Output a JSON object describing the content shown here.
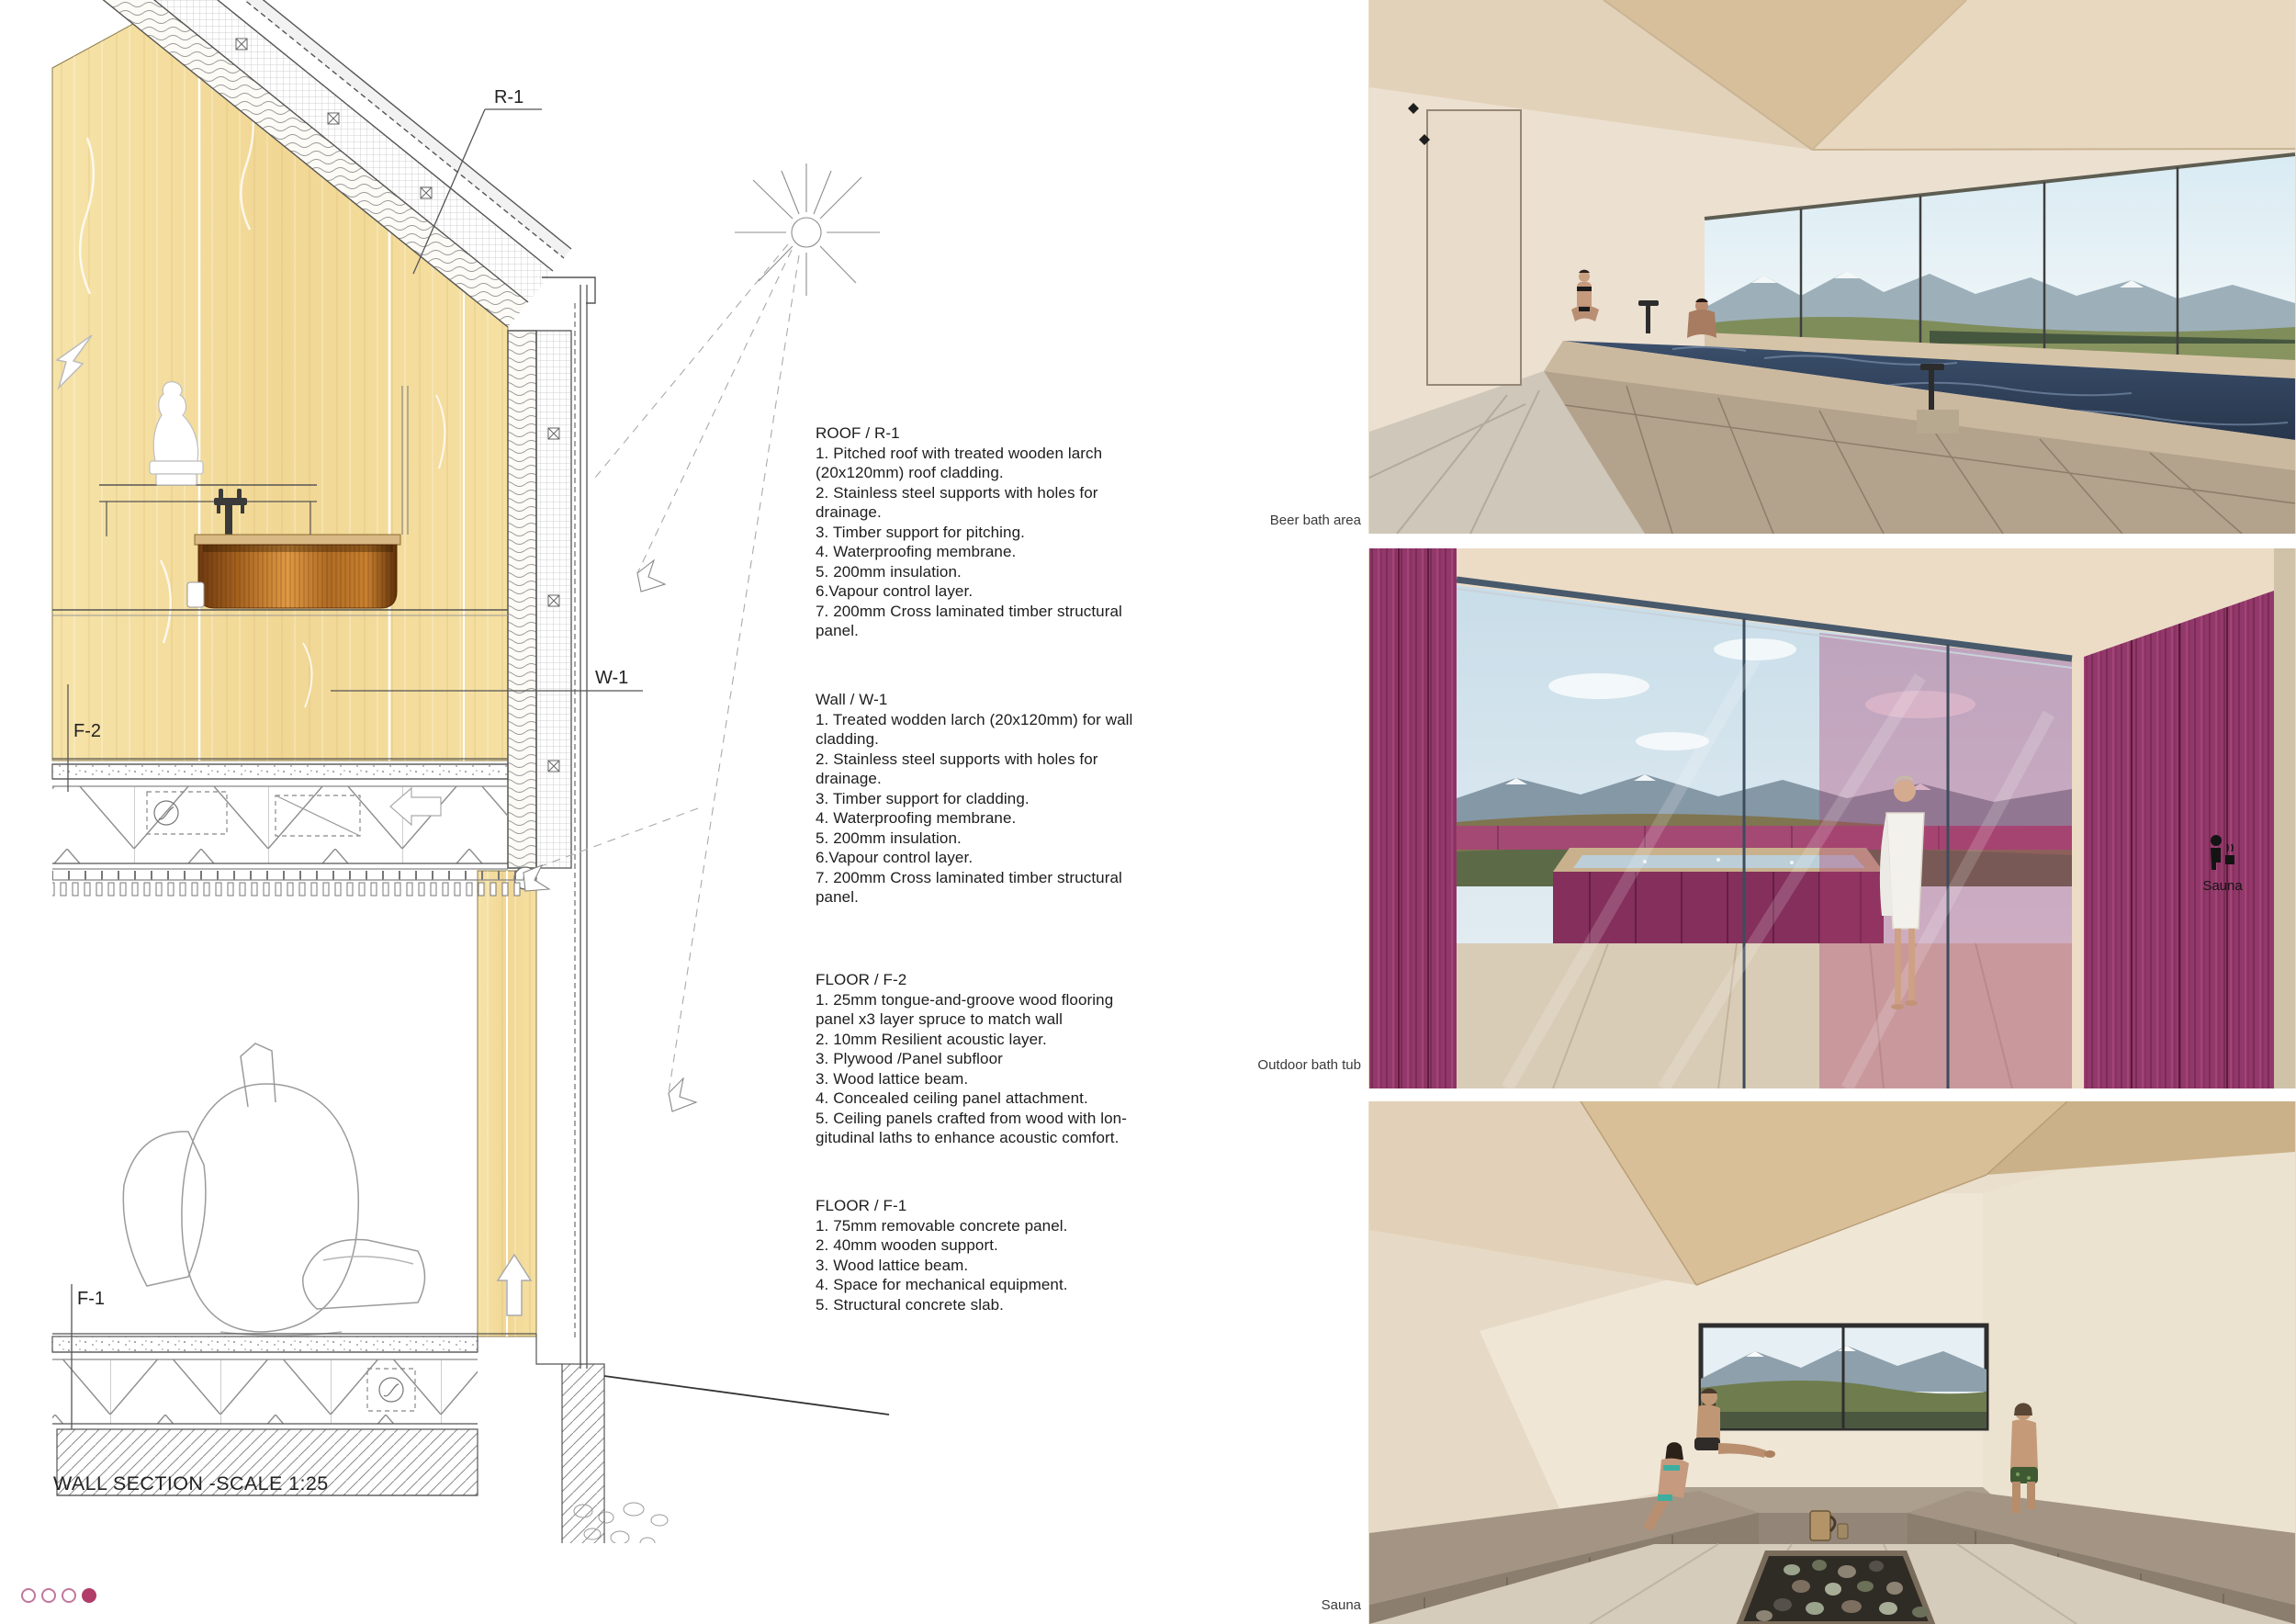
{
  "drawing": {
    "caption": "WALL SECTION -SCALE 1:25",
    "labels": {
      "roof": "R-1",
      "wall": "W-1",
      "floor_upper": "F-2",
      "floor_lower": "F-1"
    }
  },
  "notes": [
    {
      "title": "ROOF / R-1",
      "lines": [
        "1. Pitched roof with treated wooden larch",
        "(20x120mm) roof cladding.",
        "2. Stainless steel supports with holes for",
        "drainage.",
        "3. Timber support for pitching.",
        "4. Waterproofing membrane.",
        "5. 200mm insulation.",
        "6.Vapour control layer.",
        "7. 200mm Cross laminated timber structural",
        "panel."
      ]
    },
    {
      "title": "Wall / W-1",
      "lines": [
        "1. Treated wodden larch (20x120mm) for wall",
        "cladding.",
        "2. Stainless steel supports with holes for",
        "drainage.",
        "3. Timber support for cladding.",
        "4. Waterproofing membrane.",
        "5. 200mm insulation.",
        "6.Vapour control layer.",
        "7. 200mm Cross laminated timber structural",
        "panel."
      ]
    },
    {
      "title": "FLOOR / F-2",
      "lines": [
        "1. 25mm tongue-and-groove wood flooring",
        "panel x3 layer spruce to match wall",
        "2. 10mm Resilient acoustic layer.",
        "3. Plywood /Panel subfloor",
        "3. Wood lattice beam.",
        "4. Concealed ceiling panel attachment.",
        "5. Ceiling panels crafted from wood with lon-",
        "gitudinal laths to enhance acoustic comfort."
      ]
    },
    {
      "title": "FLOOR / F-1",
      "lines": [
        "1. 75mm removable concrete panel.",
        "2. 40mm wooden support.",
        "3. Wood lattice beam.",
        "4. Space for mechanical equipment.",
        "5. Structural concrete slab."
      ]
    }
  ],
  "renders": [
    {
      "caption": "Beer bath area"
    },
    {
      "caption": "Outdoor bath tub",
      "wall_sign": "Sauna"
    },
    {
      "caption": "Sauna"
    }
  ],
  "pagination": {
    "dots": 4,
    "active_dot": 4,
    "color": "#b13c69"
  },
  "colors": {
    "pine": "#f3dc9c",
    "copper": "#b96f24",
    "magenta_wood": "#8e3563",
    "accent_pink": "#b13c69"
  }
}
